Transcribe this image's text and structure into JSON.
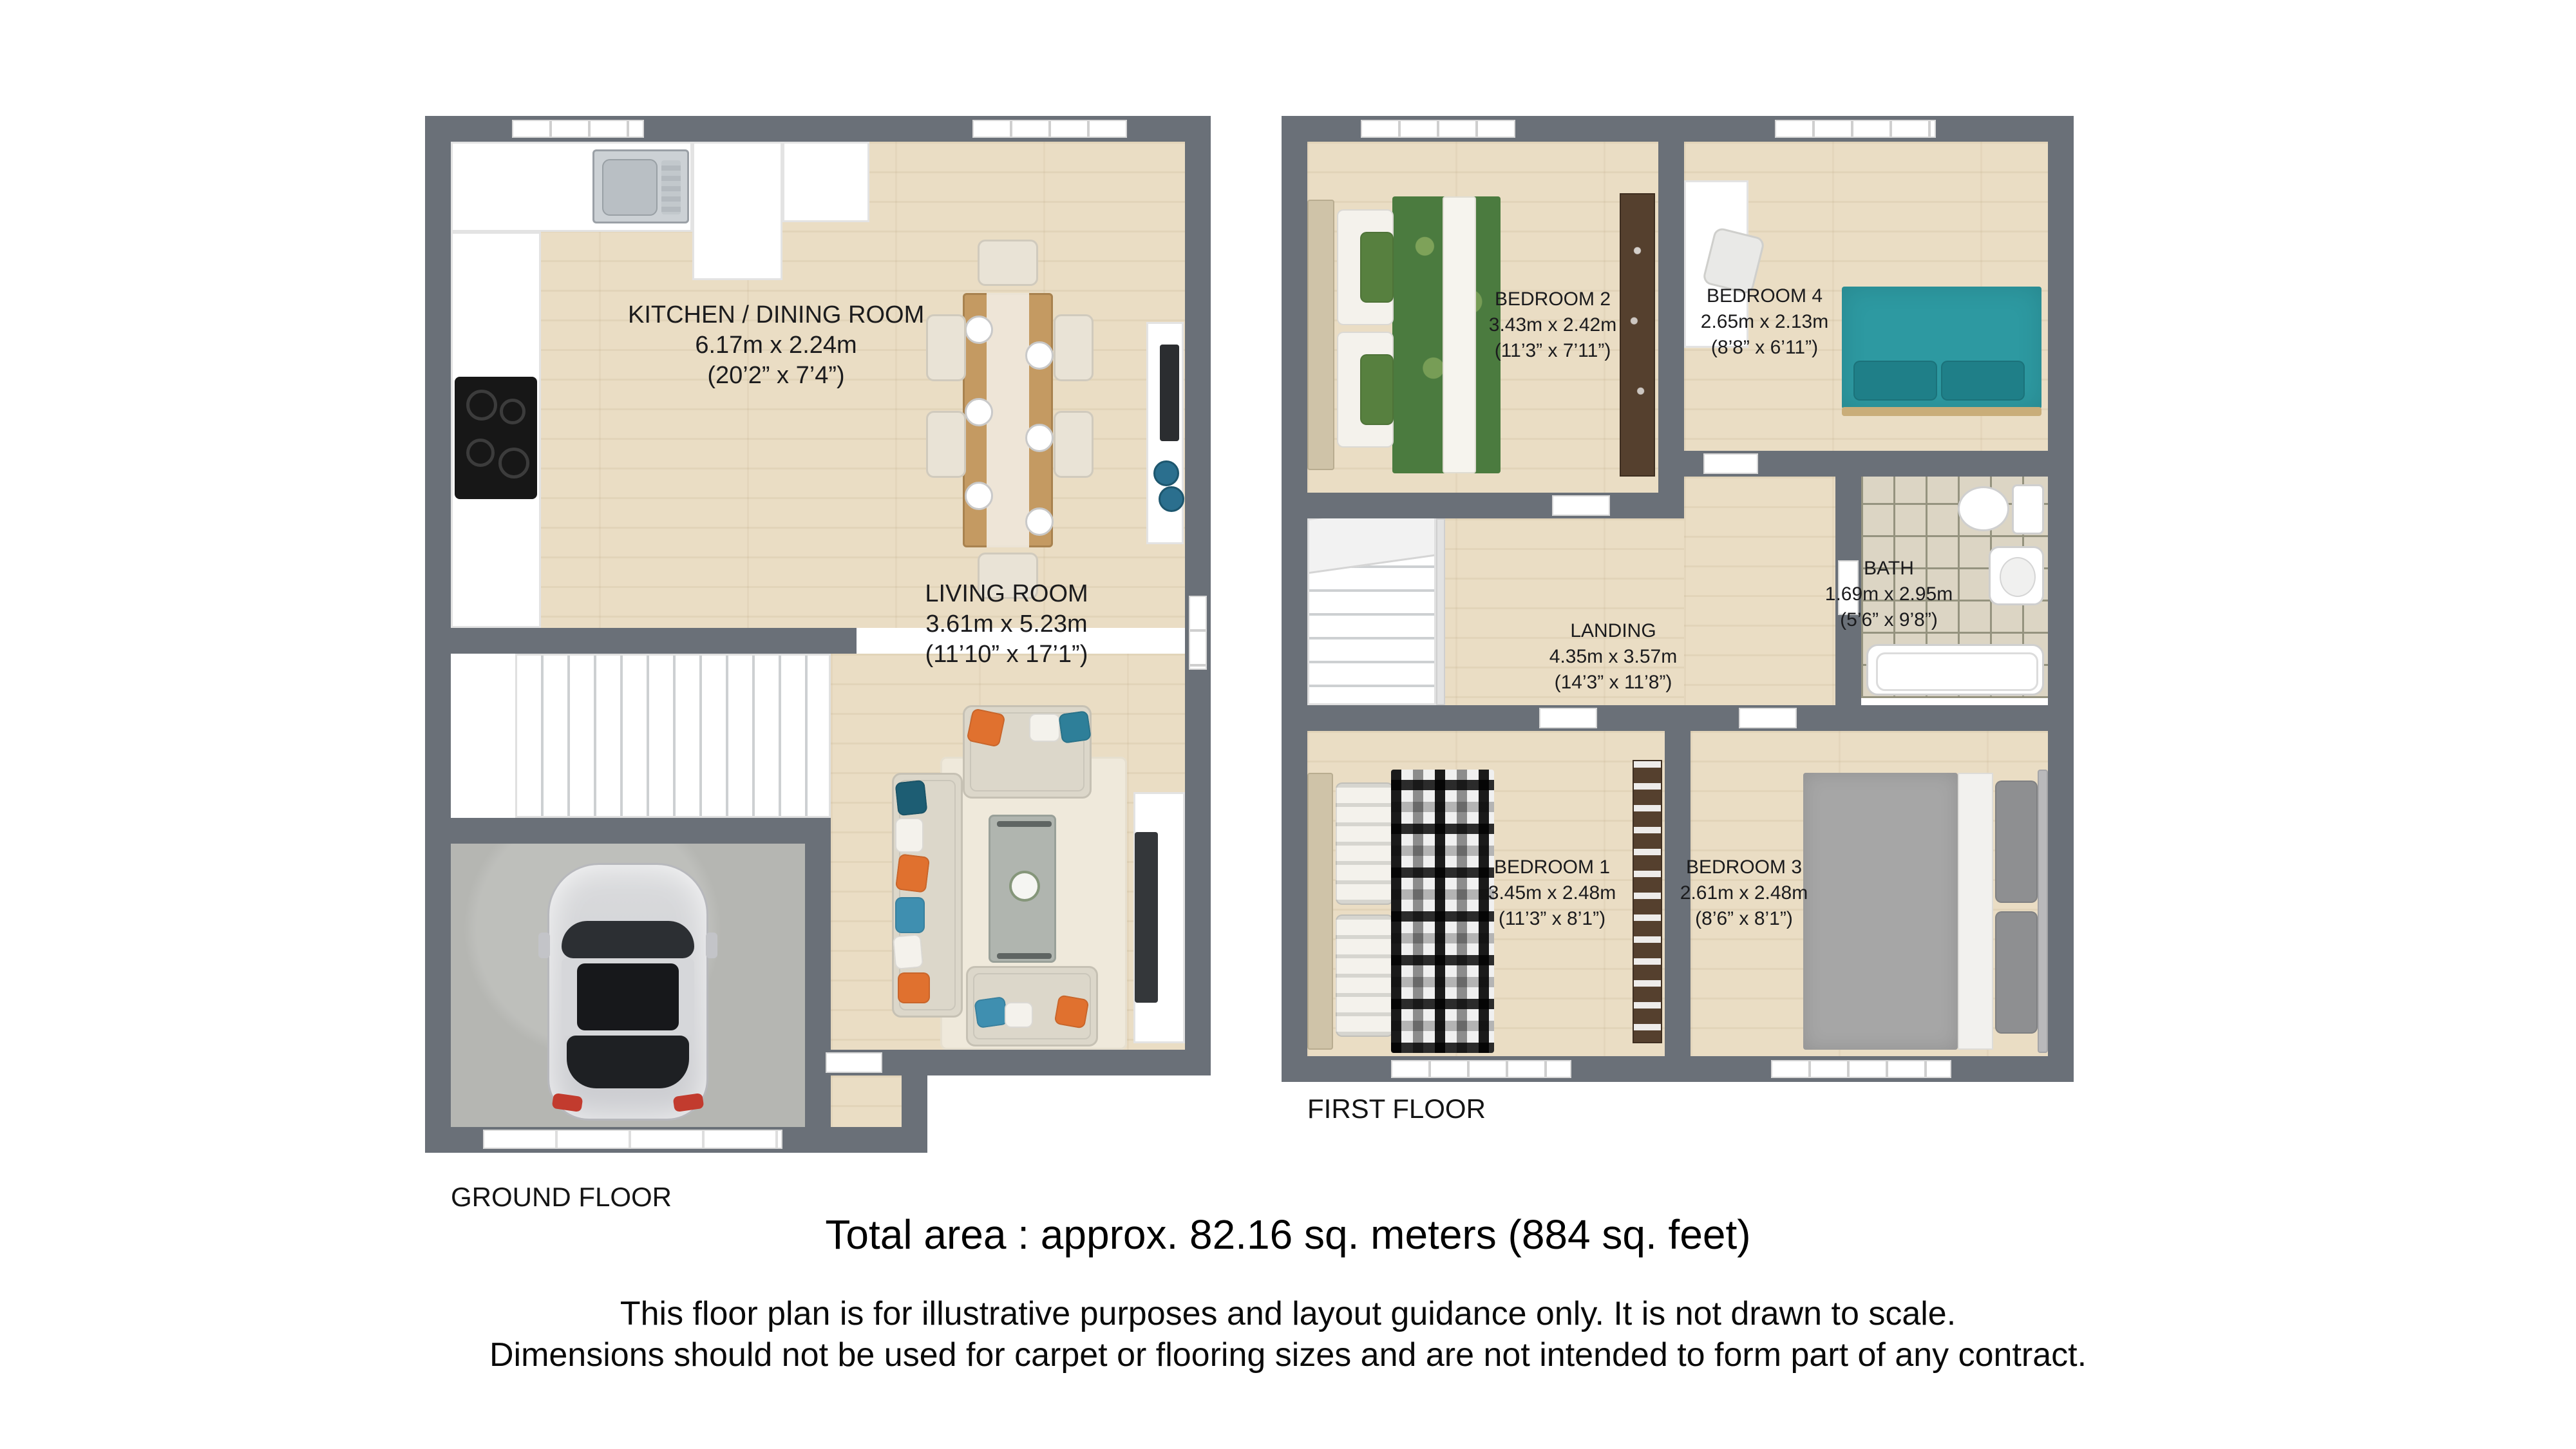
{
  "ground": {
    "label": "GROUND FLOOR",
    "rooms": {
      "kitchen": {
        "name": "KITCHEN / DINING ROOM",
        "metric": "6.17m x 2.24m",
        "imperial": "(20’2” x 7’4”)"
      },
      "living": {
        "name": "LIVING ROOM",
        "metric": "3.61m x 5.23m",
        "imperial": "(11’10” x 17’1”)"
      }
    }
  },
  "first": {
    "label": "FIRST FLOOR",
    "rooms": {
      "bedroom2": {
        "name": "BEDROOM 2",
        "metric": "3.43m x 2.42m",
        "imperial": "(11’3” x 7’11”)"
      },
      "bedroom4": {
        "name": "BEDROOM 4",
        "metric": "2.65m x 2.13m",
        "imperial": "(8’8” x 6’11”)"
      },
      "bath": {
        "name": "BATH",
        "metric": "1.69m x 2.95m",
        "imperial": "(5’6” x 9’8”)"
      },
      "landing": {
        "name": "LANDING",
        "metric": "4.35m x 3.57m",
        "imperial": "(14’3” x 11’8”)"
      },
      "bedroom1": {
        "name": "BEDROOM 1",
        "metric": "3.45m x 2.48m",
        "imperial": "(11’3” x 8’1”)"
      },
      "bedroom3": {
        "name": "BEDROOM 3",
        "metric": "2.61m x 2.48m",
        "imperial": "(8’6” x 8’1”)"
      }
    }
  },
  "footer": {
    "total_area": "Total area : approx. 82.16 sq. meters (884 sq. feet)",
    "disclaimer1": "This floor plan is for illustrative purposes and layout guidance only. It is not drawn to scale.",
    "disclaimer2": "Dimensions should not be used for carpet or flooring sizes and are not intended to form part of any contract."
  },
  "colors": {
    "wall": "#6a7078",
    "wood": "#eaddc4",
    "garage_floor": "#b5b6b2",
    "tile": "#dcd5c4",
    "bed_teal": "#2d99a1",
    "pillow_orange": "#e0712f",
    "duvet_green": "#4b7b3f",
    "sofa_beige": "#dcd7ca"
  }
}
